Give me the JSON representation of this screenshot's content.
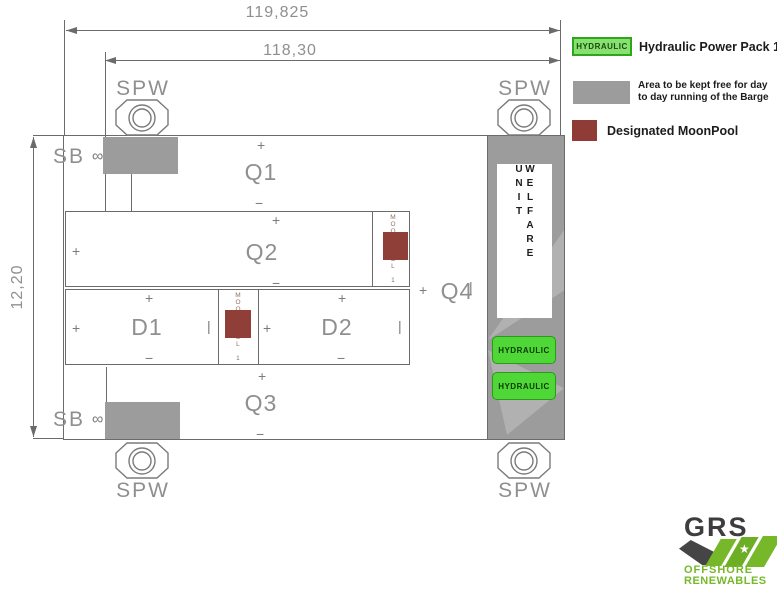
{
  "dimensions": {
    "overall_length": "119,825",
    "inner_length": "118,30",
    "beam": "12,20"
  },
  "labels": {
    "spw": "SPW",
    "sb": "SB",
    "mooring_symbol": "∞",
    "welfare_unit": "WELFARE UNIT",
    "hydraulic": "HYDRAULIC",
    "moonpool_vertical": "MOONPOOL 1"
  },
  "zones": {
    "q1": "Q1",
    "q2": "Q2",
    "q3": "Q3",
    "q4": "Q4",
    "d1": "D1",
    "d2": "D2"
  },
  "marks": {
    "plus": "+",
    "minus": "−",
    "tick": "|"
  },
  "legend": {
    "hydraulic_swatch_text": "HYDRAULIC",
    "hydraulic_label": "Hydraulic Power Pack 1 + 2",
    "free_area_line1": "Area to be kept free for day",
    "free_area_line2": "to day running of the Barge",
    "moonpool_label": "Designated MoonPool"
  },
  "logo": {
    "name": "GRS",
    "line1": "OFFSHORE",
    "line2": "RENEWABLES",
    "star": "★"
  },
  "colors": {
    "free_area_gray": "#9c9c9c",
    "moonpool_red": "#8f3f38",
    "hydraulic_green": "#4fd637",
    "legend_green": "#88e070",
    "logo_green": "#76b82a"
  }
}
